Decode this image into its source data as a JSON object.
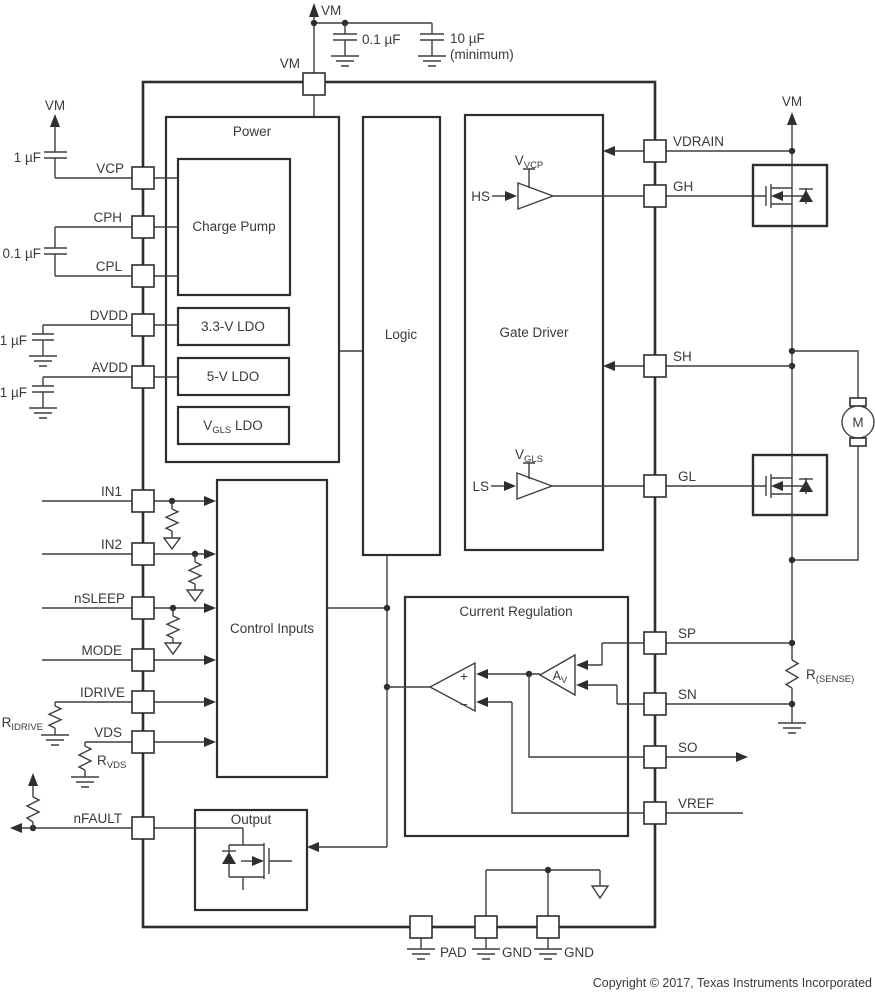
{
  "pins": {
    "top": [
      "VM"
    ],
    "left": [
      "VCP",
      "CPH",
      "CPL",
      "DVDD",
      "AVDD",
      "IN1",
      "IN2",
      "nSLEEP",
      "MODE",
      "IDRIVE",
      "VDS",
      "nFAULT"
    ],
    "right": [
      "VDRAIN",
      "GH",
      "SH",
      "GL",
      "SP",
      "SN",
      "SO",
      "VREF"
    ],
    "bottom": [
      "PAD",
      "GND",
      "GND"
    ]
  },
  "blocks": {
    "power": "Power",
    "charge_pump": "Charge Pump",
    "ldo_33": "3.3-V LDO",
    "ldo_5": "5-V LDO",
    "ldo_vgls": {
      "main": "V",
      "sub": "GLS",
      "rest": " LDO"
    },
    "logic": "Logic",
    "gate_driver": "Gate Driver",
    "control_inputs": "Control Inputs",
    "current_regulation": "Current Regulation",
    "output": "Output"
  },
  "internal": {
    "hs": "HS",
    "ls": "LS",
    "v_vcp": {
      "main": "V",
      "sub": "VCP"
    },
    "v_gls": {
      "main": "V",
      "sub": "GLS"
    },
    "av": {
      "main": "A",
      "sub": "V"
    },
    "plus": "+",
    "minus": "−"
  },
  "external": {
    "vm_top": "VM",
    "vm_left": "VM",
    "vm_right": "VM",
    "cap_vm_1": "0.1 µF",
    "cap_vm_2": "10 µF",
    "cap_vm_2_note": "(minimum)",
    "cap_vcp": "1 µF",
    "cap_cp": "0.1 µF",
    "cap_dvdd": "1 µF",
    "cap_avdd": "1 µF",
    "r_idrive": {
      "main": "R",
      "sub": "IDRIVE"
    },
    "r_vds": {
      "main": "R",
      "sub": "VDS"
    },
    "r_sense": {
      "main": "R",
      "sub": "(SENSE)"
    },
    "motor": "M"
  },
  "footer": {
    "copyright": "Copyright © 2017, Texas Instruments Incorporated"
  }
}
